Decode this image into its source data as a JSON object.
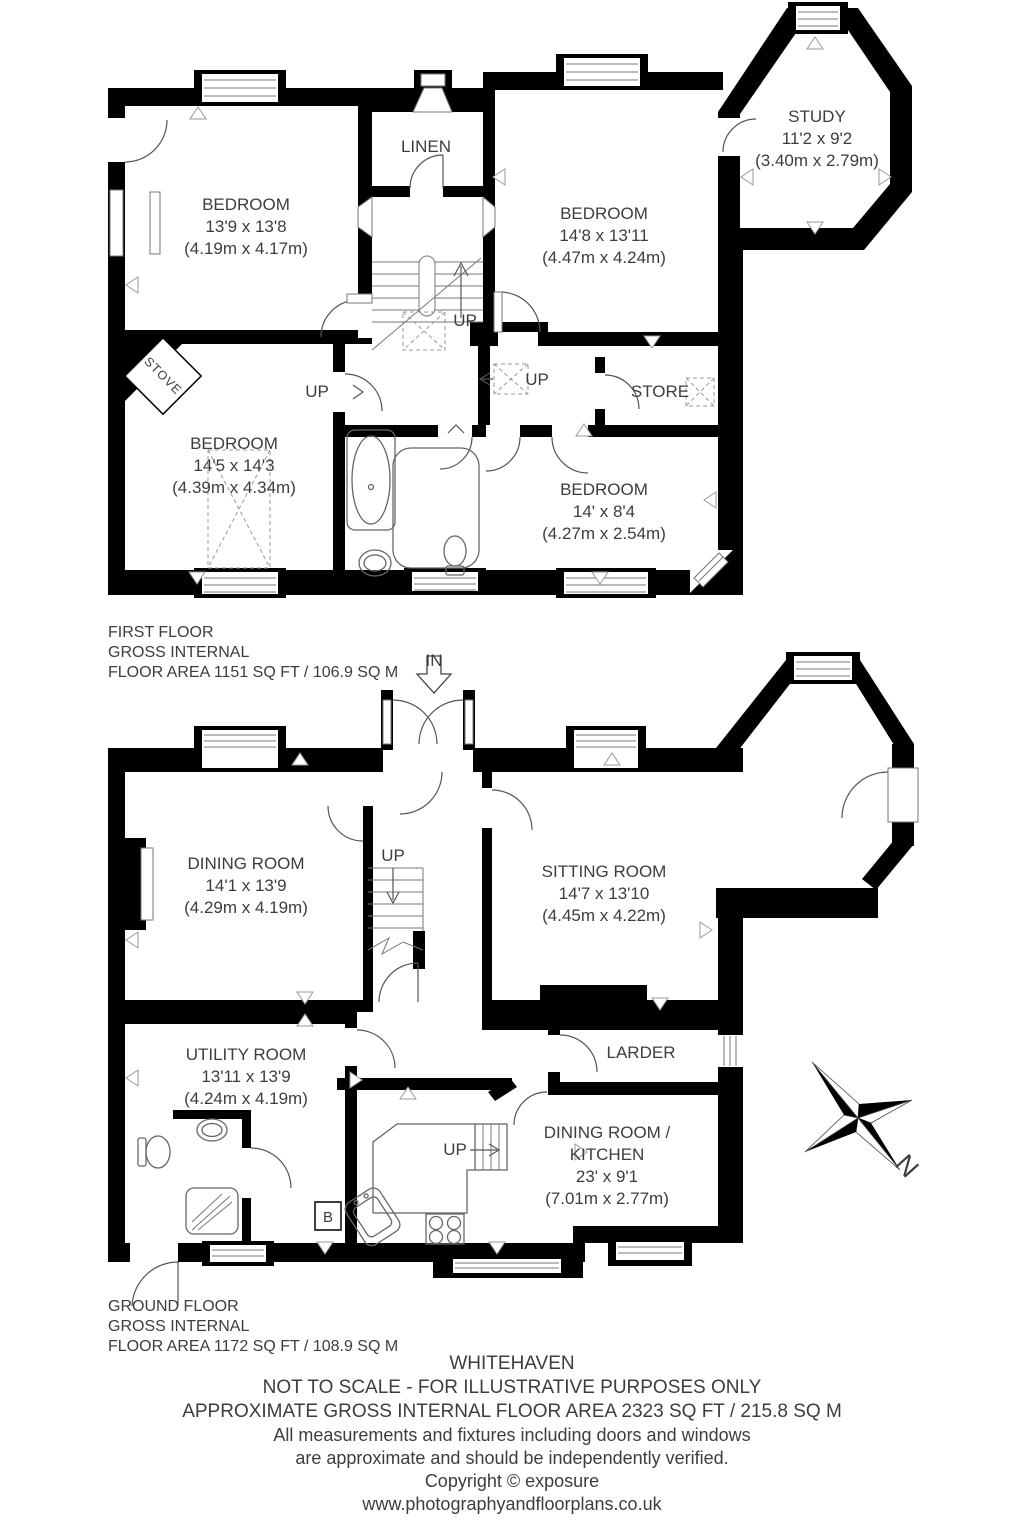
{
  "style": {
    "wall_color": "#000000",
    "text_color": "#3d3d3d"
  },
  "first_floor": {
    "summary": {
      "line1": "FIRST FLOOR",
      "line2": "GROSS INTERNAL",
      "line3": "FLOOR AREA 1151 SQ FT / 106.9 SQ M"
    },
    "rooms": {
      "bedroom_front_left": {
        "name": "BEDROOM",
        "size_ft": "13'9 x 13'8",
        "size_m": "(4.19m x 4.17m)"
      },
      "linen": {
        "name": "LINEN"
      },
      "bedroom_front_right": {
        "name": "BEDROOM",
        "size_ft": "14'8 x 13'11",
        "size_m": "(4.47m x 4.24m)"
      },
      "study": {
        "name": "STUDY",
        "size_ft": "11'2 x 9'2",
        "size_m": "(3.40m x 2.79m)"
      },
      "bedroom_back_left": {
        "name": "BEDROOM",
        "size_ft": "14'5 x 14'3",
        "size_m": "(4.39m x 4.34m)"
      },
      "store": {
        "name": "STORE"
      },
      "bedroom_back_right": {
        "name": "BEDROOM",
        "size_ft": "14' x 8'4",
        "size_m": "(4.27m x 2.54m)"
      }
    },
    "annotations": {
      "up_main": "UP",
      "up_landing": "UP",
      "up_bedroom": "UP",
      "stove": "STOVE"
    }
  },
  "ground_floor": {
    "summary": {
      "line1": "GROUND FLOOR",
      "line2": "GROSS INTERNAL",
      "line3": "FLOOR AREA 1172 SQ FT / 108.9 SQ M"
    },
    "entrance_label": "IN",
    "rooms": {
      "dining_room": {
        "name": "DINING ROOM",
        "size_ft": "14'1 x 13'9",
        "size_m": "(4.29m x 4.19m)"
      },
      "sitting_room": {
        "name": "SITTING ROOM",
        "size_ft": "14'7 x 13'10",
        "size_m": "(4.45m x 4.22m)"
      },
      "utility_room": {
        "name": "UTILITY ROOM",
        "size_ft": "13'11 x 13'9",
        "size_m": "(4.24m x 4.19m)"
      },
      "larder": {
        "name": "LARDER"
      },
      "dining_kitchen": {
        "name_line1": "DINING ROOM /",
        "name_line2": "KITCHEN",
        "size_ft": "23' x 9'1",
        "size_m": "(7.01m x 2.77m)"
      }
    },
    "annotations": {
      "up_hall": "UP",
      "up_kitchen": "UP",
      "boiler": "B"
    }
  },
  "compass": {
    "label": "N"
  },
  "footer": {
    "title": "WHITEHAVEN",
    "line2": "NOT TO SCALE - FOR ILLUSTRATIVE PURPOSES ONLY",
    "line3": "APPROXIMATE GROSS INTERNAL FLOOR AREA 2323 SQ FT / 215.8 SQ M",
    "line4": "All measurements and fixtures including doors and windows",
    "line5": "are approximate and should be independently verified.",
    "line6": "Copyright © exposure",
    "line7": "www.photographyandfloorplans.co.uk"
  }
}
